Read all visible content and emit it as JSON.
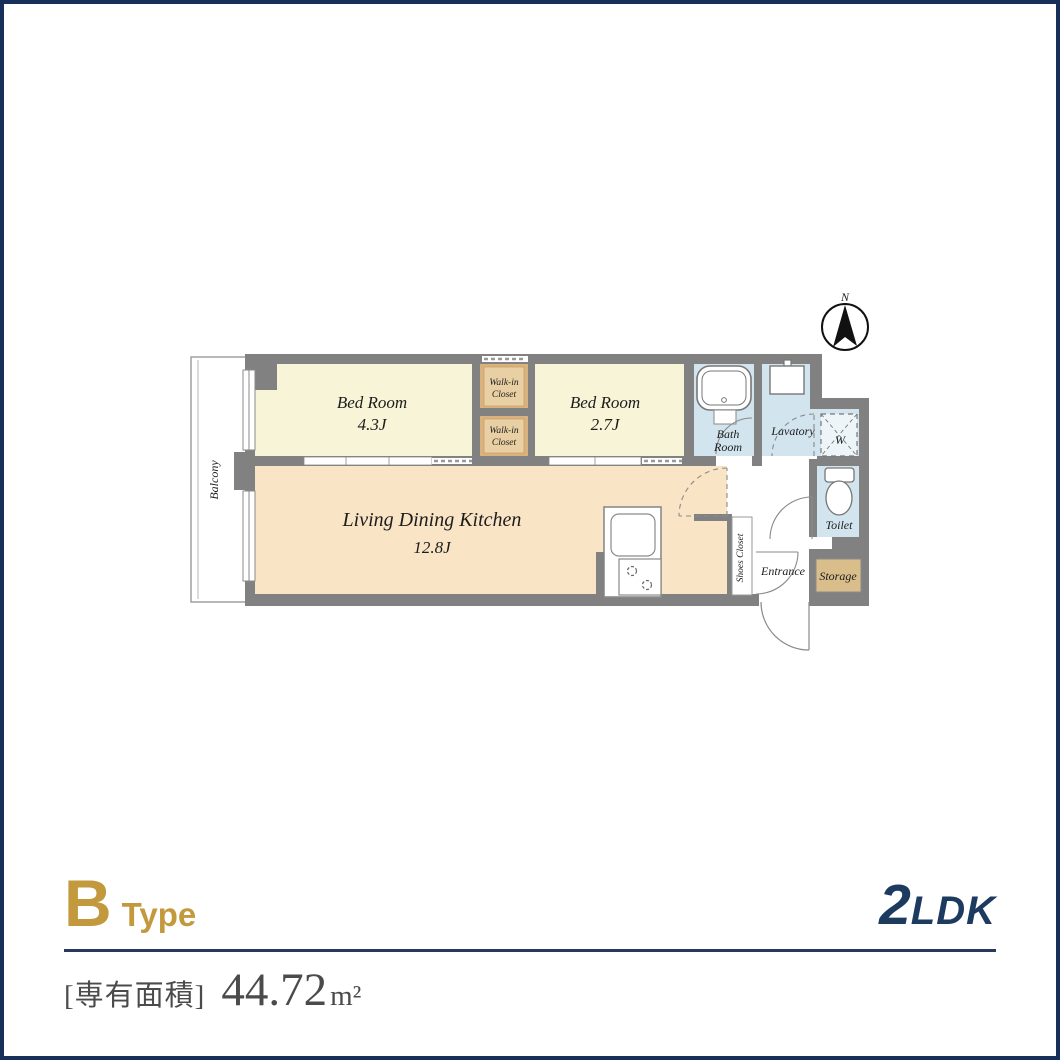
{
  "plan": {
    "north": "N",
    "balcony": "Balcony",
    "bedroom1_name": "Bed Room",
    "bedroom1_size": "4.3J",
    "wic_line1": "Walk-in",
    "wic_line2": "Closet",
    "bedroom2_name": "Bed Room",
    "bedroom2_size": "2.7J",
    "bath_line1": "Bath",
    "bath_line2": "Room",
    "lavatory": "Lavatory",
    "washer": "W",
    "ldk_name": "Living Dining Kitchen",
    "ldk_size": "12.8J",
    "shoes_closet": "Shoes Closet",
    "entrance": "Entrance",
    "storage": "Storage",
    "toilet": "Toilet"
  },
  "footer": {
    "type_letter": "B",
    "type_word": "Type",
    "layout_number": "2",
    "layout_letters": "LDK",
    "area_label": "[専有面積]",
    "area_value": "44.72",
    "area_unit": "m²"
  },
  "colors": {
    "border_navy": "#16305a",
    "accent_gold": "#c3993d",
    "layout_navy": "#1d3a5f",
    "wall_gray": "#818181",
    "bedroom_cream": "#f8f4d7",
    "ldk_peach": "#fae4c6",
    "closet_tan": "#e5cda0",
    "storage_tan": "#d9bd8b",
    "water_blue": "#d2e4ee"
  }
}
